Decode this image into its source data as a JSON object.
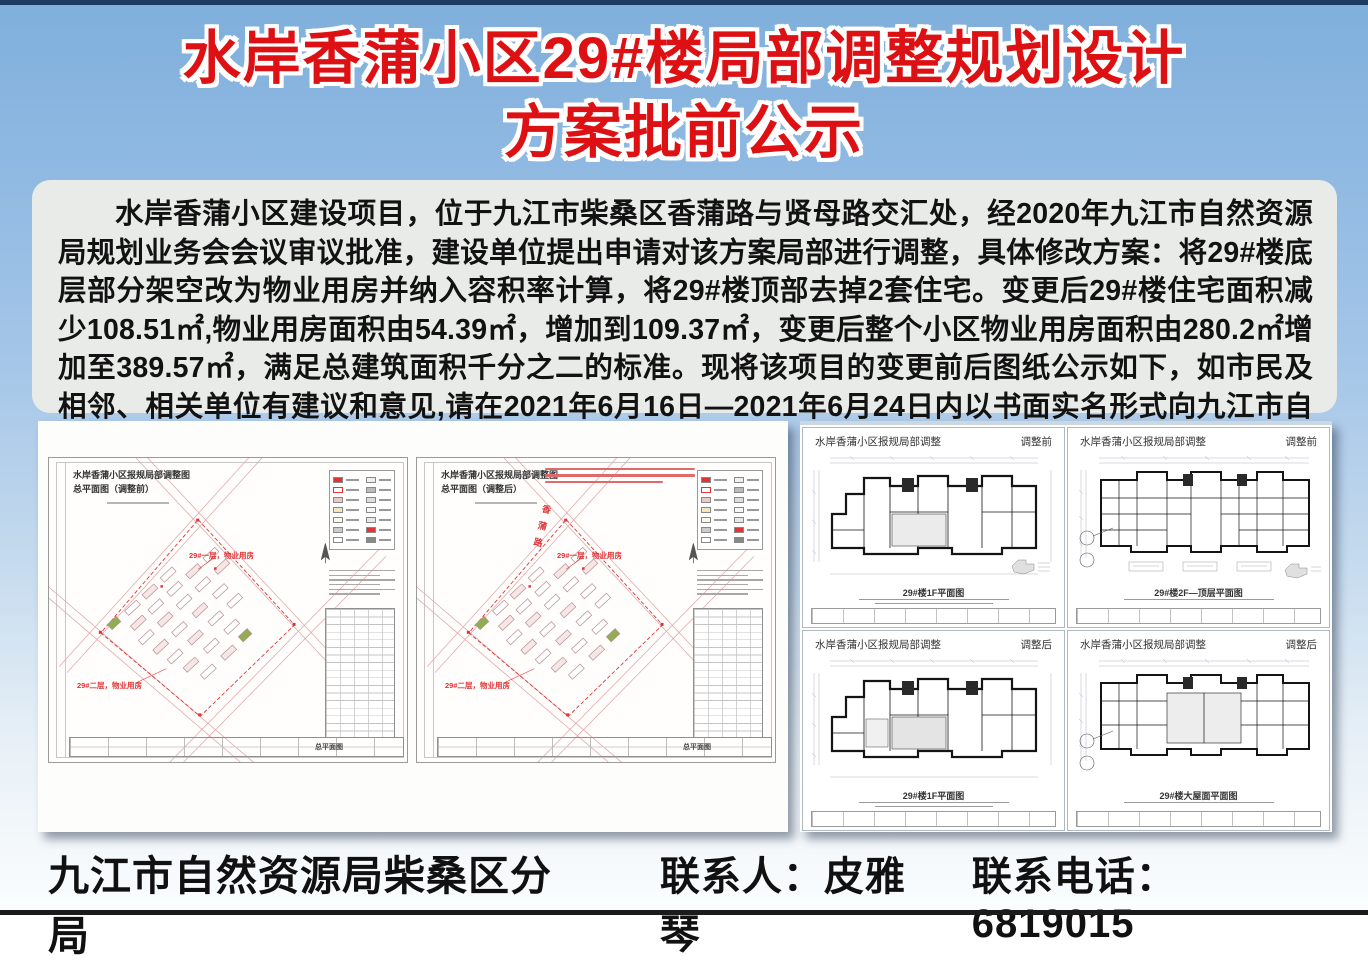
{
  "header": {
    "title_line1": "水岸香蒲小区29#楼局部调整规划设计",
    "title_line2": "方案批前公示"
  },
  "notice": {
    "paragraph": "水岸香蒲小区建设项目，位于九江市柴桑区香蒲路与贤母路交汇处，经2020年九江市自然资源局规划业务会会议审议批准，建设单位提出申请对该方案局部进行调整，具体修改方案：将29#楼底层部分架空改为物业用房并纳入容积率计算，将29#楼顶部去掉2套住宅。变更后29#楼住宅面积减少108.51㎡,物业用房面积由54.39㎡，增加到109.37㎡，变更后整个小区物业用房面积由280.2㎡增加至389.57㎡，满足总建筑面积千分之二的标准。现将该项目的变更前后图纸公示如下，如市民及相邻、相关单位有建议和意见,请在2021年6月16日—2021年6月24日内以书面实名形式向九江市自然资源局柴桑区分局反映。"
  },
  "left_panel": {
    "sheets": [
      {
        "title": "水岸香蒲小区报规局部调整图",
        "subtitle": "总平面图（调整前）",
        "callout_top": "29#一层，物业用房",
        "callout_bottom": "29#二层，物业用房",
        "titleblock_caption": "总平面图"
      },
      {
        "title": "水岸香蒲小区报规局部调整图",
        "subtitle": "总平面图（调整后）",
        "callout_top": "29#一层，物业用房",
        "callout_bottom": "29#二层，物业用房",
        "road_label": "香蒲路",
        "titleblock_caption": "总平面图"
      }
    ]
  },
  "right_panel": {
    "sheets": [
      {
        "header_left": "水岸香蒲小区报规局部调整",
        "header_right": "调整前",
        "caption": "29#楼1F平面图"
      },
      {
        "header_left": "水岸香蒲小区报规局部调整",
        "header_right": "调整前",
        "caption": "29#楼2F—顶层平面图"
      },
      {
        "header_left": "水岸香蒲小区报规局部调整",
        "header_right": "调整后",
        "caption": "29#楼1F平面图"
      },
      {
        "header_left": "水岸香蒲小区报规局部调整",
        "header_right": "调整后",
        "caption": "29#楼大屋面平面图"
      }
    ]
  },
  "footer": {
    "org": "九江市自然资源局柴桑区分局",
    "contact": "联系人：皮雅琴",
    "phone": "联系电话：6819015"
  },
  "colors": {
    "title_red": "#dd1014",
    "background_blue_top": "#7fafdc",
    "background_bottom": "#fbfdfe",
    "notice_background": "#e9ebe9",
    "annotation_red": "#e03436",
    "top_strip_navy": "#1d3a5f"
  }
}
